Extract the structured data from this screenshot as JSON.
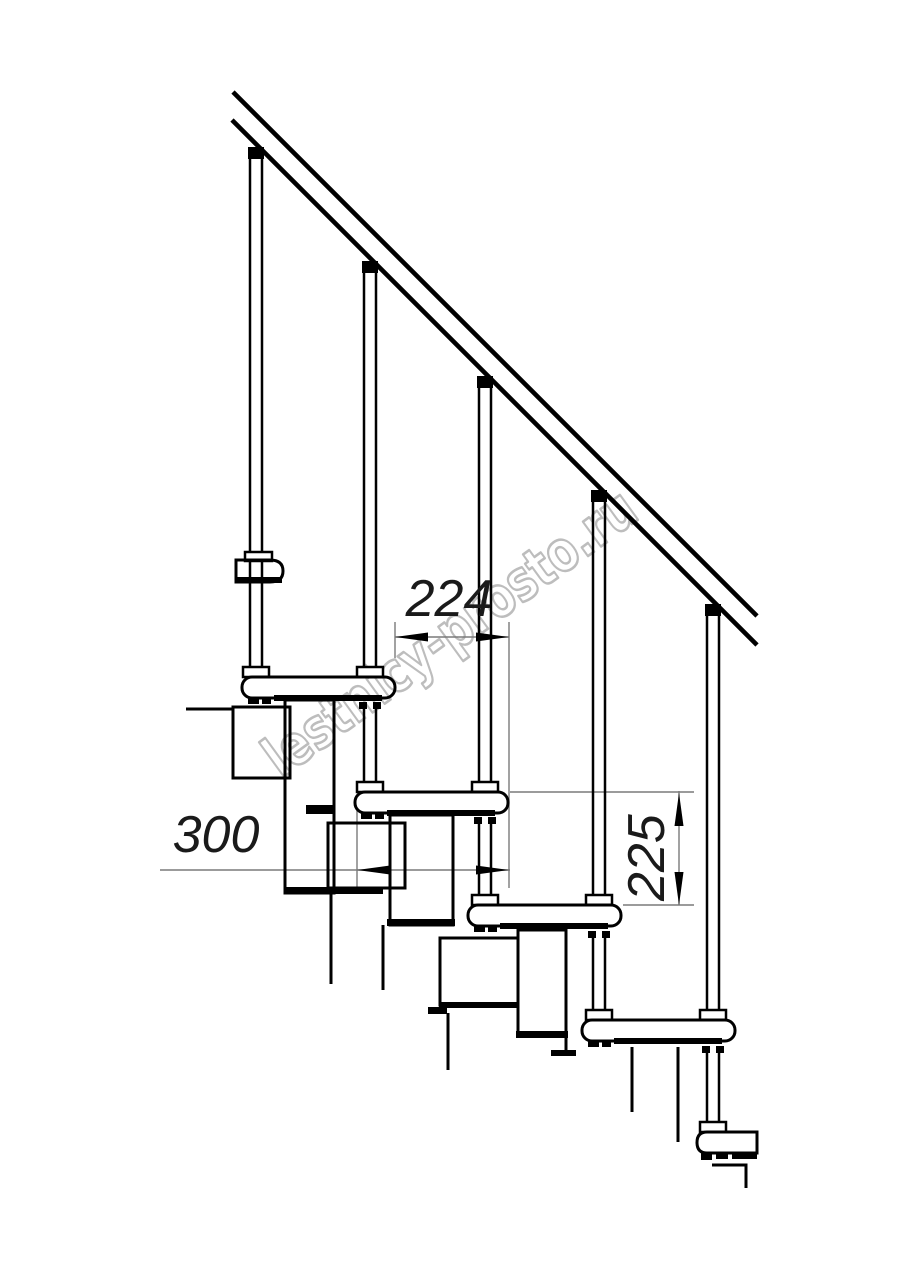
{
  "drawing": {
    "title": "modular-staircase-side-elevation",
    "watermark": {
      "text": "lestnicy-prosto.ru"
    },
    "dimensions": {
      "step_run_label": "224",
      "tread_depth_label": "300",
      "step_rise_label": "225"
    },
    "colors": {
      "ink": "#000000",
      "dimension_line": "#7a7a7a",
      "dimension_text": "#1a1a1a",
      "watermark": "#bdbdbd",
      "background": "#ffffff"
    }
  }
}
